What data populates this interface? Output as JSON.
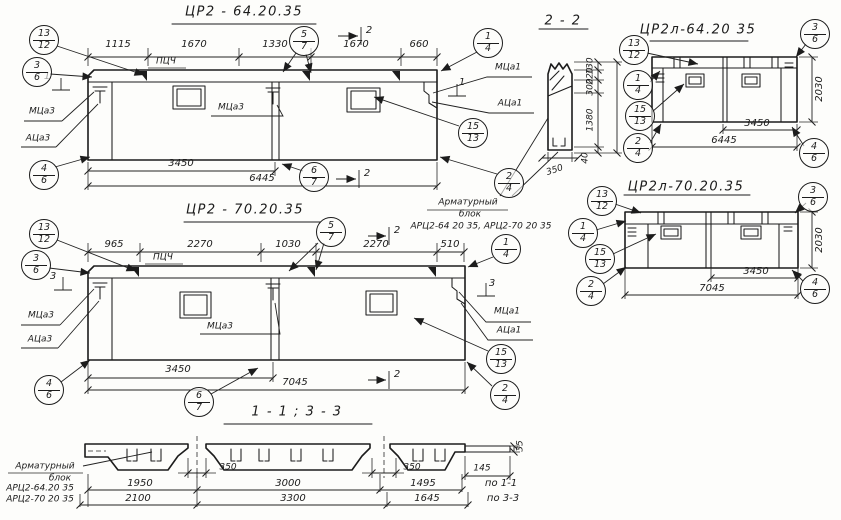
{
  "ink": "#1c1c1c",
  "d1": {
    "title": "ЦР2 - 64.20.35",
    "dims_top": [
      "1115",
      "1670",
      "1330",
      "1670",
      "660"
    ],
    "pcch": "ПЦЧ",
    "dim_a": "3450",
    "dim_b": "6445",
    "sec_side": "1",
    "sec_cut": "2",
    "lbl_mca3_left": "МЦа3",
    "lbl_aca3": "АЦа3",
    "lbl_mca3_mid": "МЦа3",
    "lbl_mca1": "МЦа1",
    "lbl_aca1": "АЦа1",
    "callouts": [
      {
        "t": "13",
        "b": "12"
      },
      {
        "t": "3",
        "b": "6"
      },
      {
        "t": "5",
        "b": "7"
      },
      {
        "t": "1",
        "b": "4"
      },
      {
        "t": "15",
        "b": "13"
      },
      {
        "t": "2",
        "b": "4"
      },
      {
        "t": "4",
        "b": "6"
      },
      {
        "t": "6",
        "b": "7"
      }
    ]
  },
  "d2": {
    "title": "ЦР2 - 70.20.35",
    "dims_top": [
      "965",
      "2270",
      "1030",
      "2270",
      "510"
    ],
    "pcch": "ПЦЧ",
    "dim_a": "3450",
    "dim_b": "7045",
    "sec_side": "3",
    "sec_cut": "2",
    "lbl_mca3_left": "МЦа3",
    "lbl_aca3": "АЦа3",
    "lbl_mca3_mid": "МЦа3",
    "lbl_mca1": "МЦа1",
    "lbl_aca1": "АЦа1",
    "callouts": [
      {
        "t": "13",
        "b": "12"
      },
      {
        "t": "3",
        "b": "6"
      },
      {
        "t": "5",
        "b": "7"
      },
      {
        "t": "1",
        "b": "4"
      },
      {
        "t": "15",
        "b": "13"
      },
      {
        "t": "2",
        "b": "4"
      },
      {
        "t": "4",
        "b": "6"
      },
      {
        "t": "6",
        "b": "7"
      }
    ]
  },
  "s22": {
    "title": "2 - 2",
    "dims": [
      "130",
      "220",
      "300",
      "1380",
      "40"
    ],
    "dim_350": "350",
    "note_line1": "Арматурный",
    "note_line2": "блок",
    "note_line3": "АРЦ2-64 20 35, АРЦ2-70 20 35"
  },
  "r1": {
    "title": "ЦР2л-64.20 35",
    "dim_a": "3450",
    "dim_b": "6445",
    "dim_h": "2030",
    "callouts": [
      {
        "t": "13",
        "b": "12"
      },
      {
        "t": "1",
        "b": "4"
      },
      {
        "t": "15",
        "b": "13"
      },
      {
        "t": "2",
        "b": "4"
      },
      {
        "t": "3",
        "b": "6"
      },
      {
        "t": "4",
        "b": "6"
      }
    ]
  },
  "r2": {
    "title": "ЦР2л-70.20.35",
    "dim_a": "3450",
    "dim_b": "7045",
    "dim_h": "2030",
    "callouts": [
      {
        "t": "13",
        "b": "12"
      },
      {
        "t": "1",
        "b": "4"
      },
      {
        "t": "15",
        "b": "13"
      },
      {
        "t": "2",
        "b": "4"
      },
      {
        "t": "3",
        "b": "6"
      },
      {
        "t": "4",
        "b": "6"
      }
    ]
  },
  "sb": {
    "title": "1 - 1  ;  3 - 3",
    "note_line1": "Арматурный",
    "note_line2": "блок",
    "note_line3": "АРЦ2-64.20 35",
    "note_line4": "АРЦ2-70 20 35",
    "dim_350a": "350",
    "dim_350b": "350",
    "dim_145": "145",
    "dim_35": "35",
    "row1": [
      "1950",
      "3000",
      "1495",
      "по 1-1"
    ],
    "row2": [
      "2100",
      "3300",
      "1645",
      "по 3-3"
    ]
  }
}
